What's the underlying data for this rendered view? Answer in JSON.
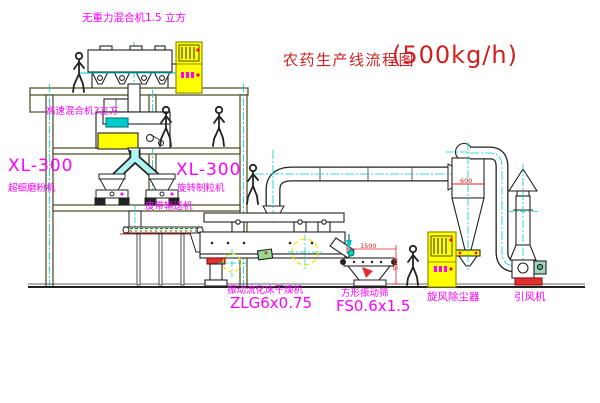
{
  "title": {
    "name": "农药生产线流程图",
    "capacity": "(500kg/h)"
  },
  "equipment_labels": {
    "gravity_mixer": "无重力混合机1.5 立方",
    "high_speed_mixer": "高速混合机3立方",
    "mill_model": "XL-300",
    "mill_name": "超细磨粉机",
    "granulator_model": "XL-300",
    "granulator_name": "旋转制粒机",
    "belt_conveyor": "皮带输送机",
    "fluid_bed_dryer": "振动流化床干燥机",
    "fluid_bed_dryer_model": "ZLG6x0.75",
    "square_vibrating_sieve": "方形振动筛",
    "square_vibrating_sieve_model": "FS0.6x1.5",
    "cyclone_dust_collector": "旋风除尘器",
    "induced_draft_fan": "引风机"
  },
  "dimensions": {
    "sieve_length": "1500",
    "sieve_height": "945",
    "cyclone_width": "600"
  },
  "colors": {
    "label_magenta": "#ff00ff",
    "title_red": "#cf2020",
    "structure_olive": "#55552a",
    "machine_dark": "#222222",
    "pipe_cyan": "#00cccc",
    "cabinet_yellow": "#ffff00",
    "accent_red": "#e03030"
  }
}
